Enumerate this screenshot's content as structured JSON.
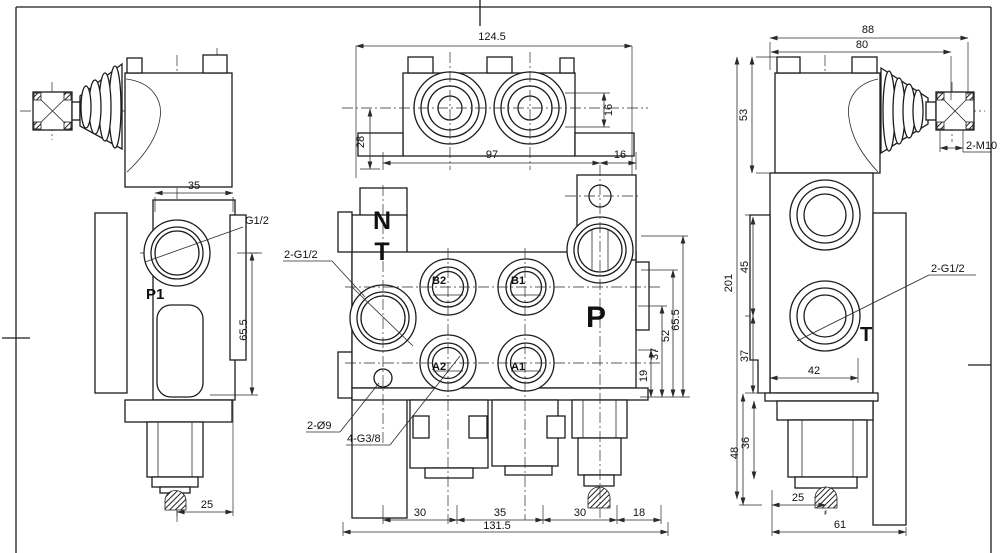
{
  "drawing": {
    "type": "hydraulic-monoblock-valve-3-view-drawing",
    "line_color": "#1c1c1c",
    "background": "#ffffff"
  },
  "left_view": {
    "label_p1": "P1",
    "label_g12": "G1/2",
    "dim_width": "35",
    "dim_height": "65.5",
    "dim_relief": "25"
  },
  "front_view": {
    "dim_overall_width": "124.5",
    "dim_28": "28",
    "dim_16_side": "16",
    "dim_97": "97",
    "dim_16_bottom": "16",
    "label_n": "N",
    "label_t": "T",
    "label_p": "P",
    "label_b2": "B2",
    "label_b1": "B1",
    "label_a2": "A2",
    "label_a1": "A1",
    "label_inlet_ports": "2-G1/2",
    "label_mount_holes": "2-Ø9",
    "label_work_ports": "4-G3/8",
    "dim_19": "19",
    "dim_37": "37",
    "dim_52": "52",
    "dim_65_5": "65.5",
    "dim_30a": "30",
    "dim_35": "35",
    "dim_30b": "30",
    "dim_18": "18",
    "dim_total_width": "131.5"
  },
  "right_view": {
    "dim_88": "88",
    "dim_80": "80",
    "dim_53": "53",
    "label_studs": "2-M10",
    "dim_201": "201",
    "dim_45": "45",
    "dim_37": "37",
    "dim_42": "42",
    "label_ports": "2-G1/2",
    "label_t": "T",
    "dim_48": "48",
    "dim_36": "36",
    "dim_25": "25",
    "dim_61": "61"
  }
}
